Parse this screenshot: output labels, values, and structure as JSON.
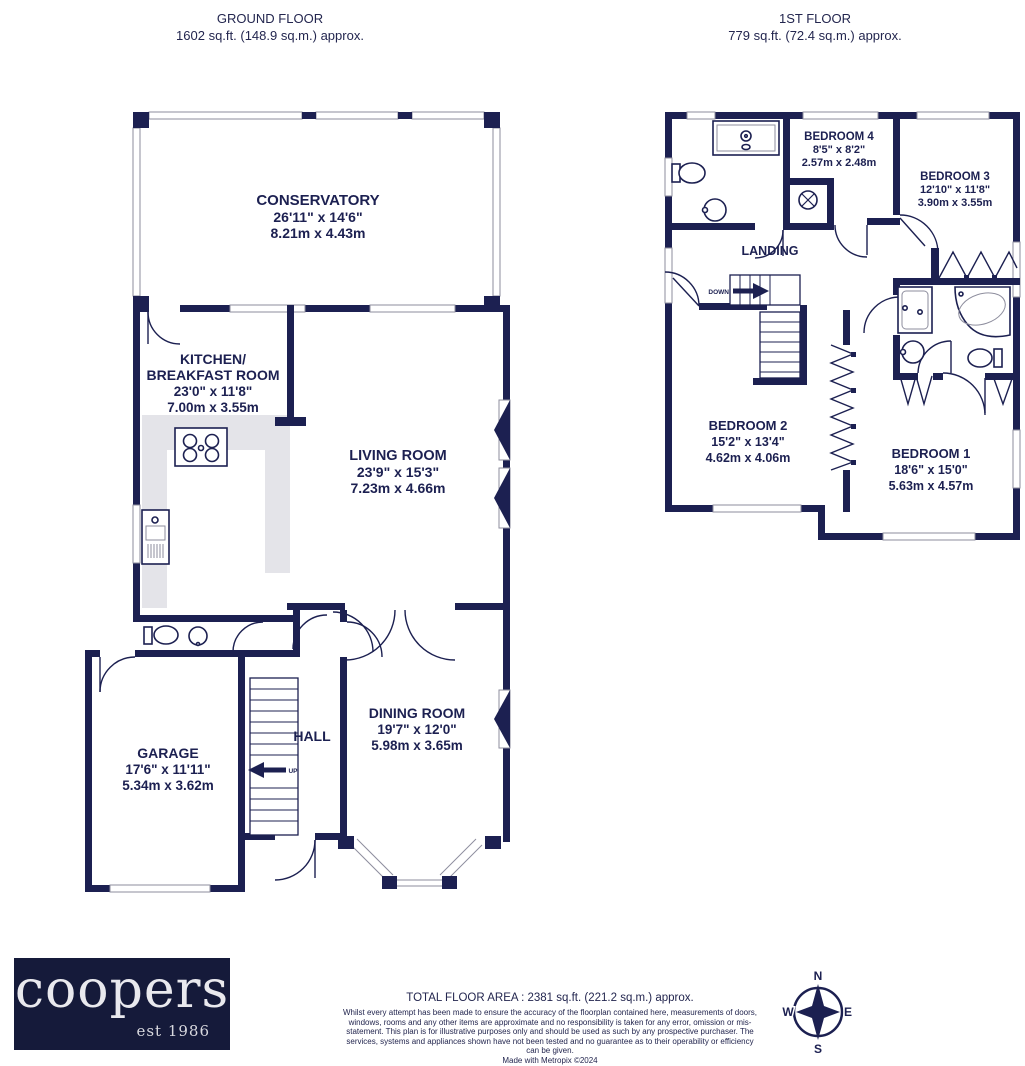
{
  "palette": {
    "wall": "#1c2051",
    "counter": "#e4e4e9",
    "logo_bg": "#151a3a",
    "text": "#1c2051"
  },
  "headers": {
    "ground": {
      "title": "GROUND FLOOR",
      "area": "1602 sq.ft. (148.9 sq.m.) approx."
    },
    "first": {
      "title": "1ST FLOOR",
      "area": "779 sq.ft. (72.4 sq.m.) approx."
    }
  },
  "ground_floor": {
    "conservatory": {
      "name": "CONSERVATORY",
      "ft": "26'11\" x 14'6\"",
      "m": "8.21m x 4.43m"
    },
    "kitchen": {
      "name1": "KITCHEN/",
      "name2": "BREAKFAST ROOM",
      "ft": "23'0\" x 11'8\"",
      "m": "7.00m x 3.55m"
    },
    "living": {
      "name": "LIVING ROOM",
      "ft": "23'9\" x 15'3\"",
      "m": "7.23m x 4.66m"
    },
    "dining": {
      "name": "DINING ROOM",
      "ft": "19'7\" x 12'0\"",
      "m": "5.98m x 3.65m"
    },
    "garage": {
      "name": "GARAGE",
      "ft": "17'6\" x 11'11\"",
      "m": "5.34m x 3.62m"
    },
    "hall": "HALL",
    "up": "UP"
  },
  "first_floor": {
    "bedroom4": {
      "name": "BEDROOM 4",
      "ft": "8'5\" x 8'2\"",
      "m": "2.57m x 2.48m"
    },
    "bedroom3": {
      "name": "BEDROOM 3",
      "ft": "12'10\" x 11'8\"",
      "m": "3.90m x 3.55m"
    },
    "bedroom2": {
      "name": "BEDROOM 2",
      "ft": "15'2\" x 13'4\"",
      "m": "4.62m x 4.06m"
    },
    "bedroom1": {
      "name": "BEDROOM 1",
      "ft": "18'6\" x 15'0\"",
      "m": "5.63m x 4.57m"
    },
    "landing": "LANDING",
    "down": "DOWN"
  },
  "footer": {
    "logo": {
      "brand": "coopers",
      "tagline": "est 1986"
    },
    "total_area": "TOTAL FLOOR AREA : 2381 sq.ft. (221.2 sq.m.) approx.",
    "disclaimer": "Whilst every attempt has been made to ensure the accuracy of the floorplan contained here, measurements of doors, windows, rooms and any other items are approximate and no responsibility is taken for any error, omission or mis-statement. This plan is for illustrative purposes only and should be used as such by any prospective purchaser. The services, systems and appliances shown have not been tested and no guarantee as to their operability or efficiency can be given.",
    "credit": "Made with Metropix ©2024"
  },
  "compass": {
    "n": "N",
    "s": "S",
    "e": "E",
    "w": "W"
  }
}
